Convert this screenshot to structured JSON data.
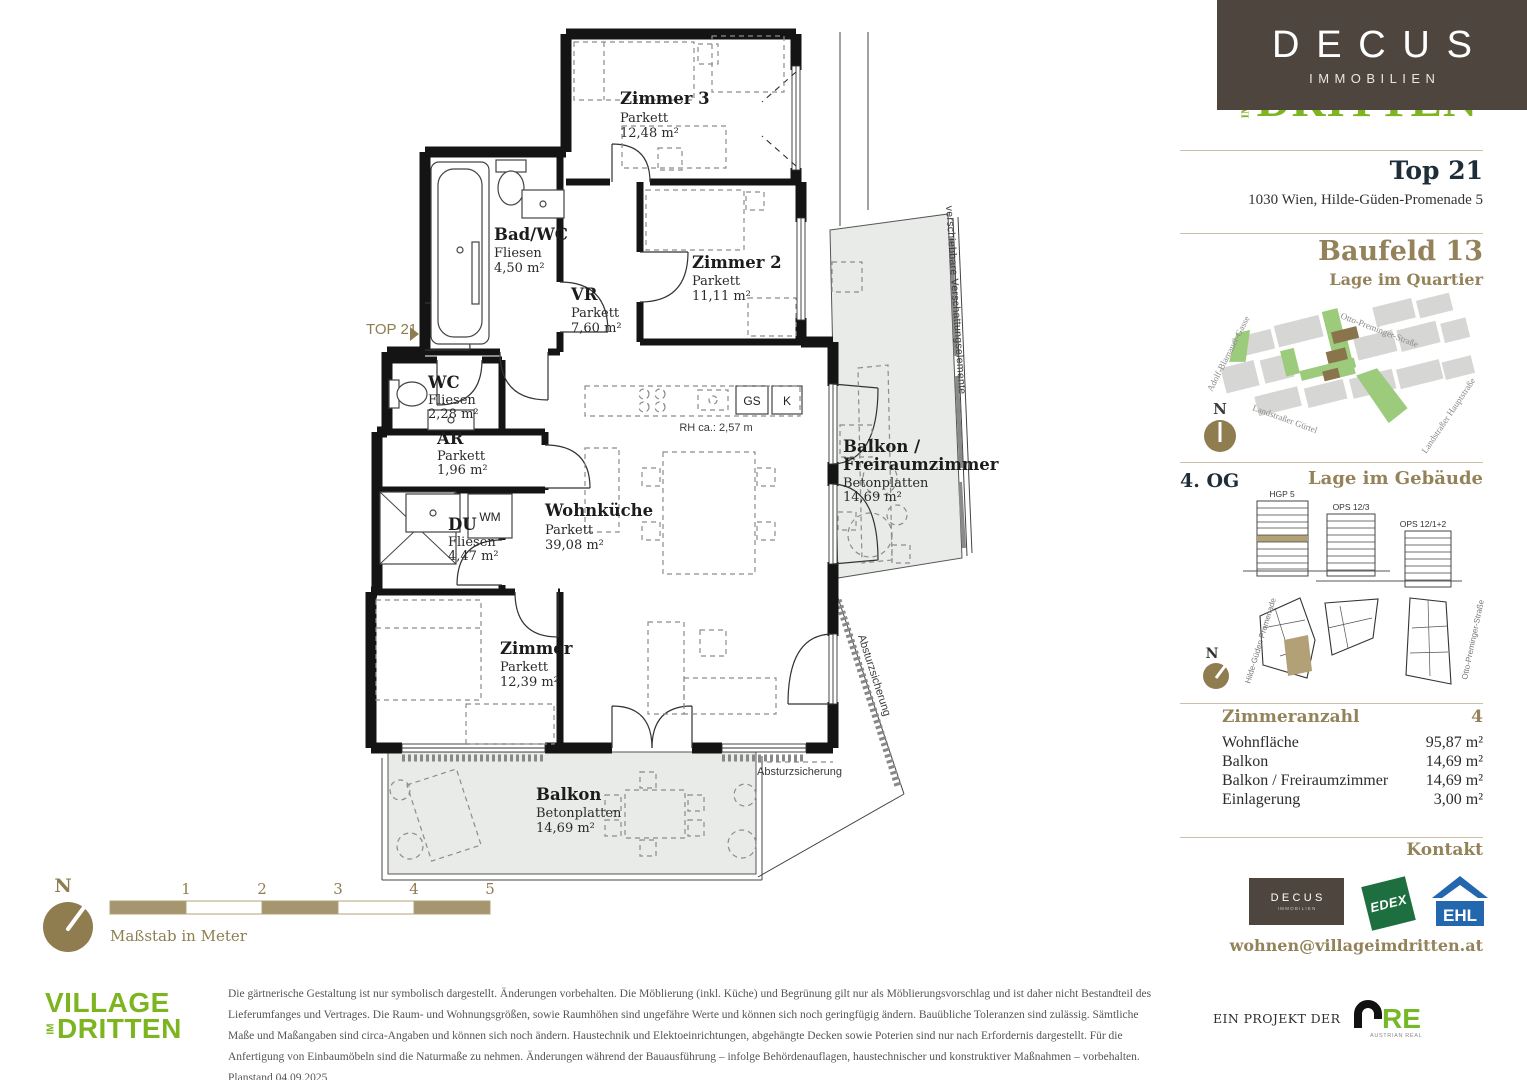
{
  "colors": {
    "brand_brown": "#94835A",
    "compass_brown": "#8F7D50",
    "village_green": "#7CB520",
    "decus_box": "#4D453E",
    "edex_green": "#1E6F40",
    "ehl_blue": "#2367AE",
    "are_green": "#76B82A",
    "map_green": "#9CCB7C",
    "map_gray": "#D6D6D4",
    "map_brown_building": "#8A744C",
    "highlight_tan": "#B2A177",
    "balcony_fill": "#E9EBE8",
    "heading_dark": "#1F2D38",
    "disclaimer_gray": "#555555"
  },
  "header": {
    "decus_logo": {
      "name": "DECUS",
      "sub": "IMMOBILIEN"
    },
    "partial_logo": {
      "im": "IM",
      "text": "DRITTEN"
    },
    "unit_title": "Top 21",
    "address": "1030 Wien, Hilde-Güden-Promenade 5",
    "baufeld": "Baufeld 13",
    "quartier_heading": "Lage im Quartier"
  },
  "map": {
    "compass": "N",
    "streets": {
      "s1": "Adolf-Blamauer-Gasse",
      "s2": "Otto-Preminger-Straße",
      "s3": "Landstraßer Gürtel",
      "s4": "Landstraßer Hauptstraße"
    }
  },
  "building": {
    "floor_label": "4. OG",
    "heading": "Lage im Gebäude",
    "compass": "N",
    "elevations": {
      "e1": "HGP 5",
      "e2": "OPS 12/3",
      "e3": "OPS 12/1+2"
    },
    "streets": {
      "left": "Hilde-Güden-Promenade",
      "right": "Otto-Preminger-Straße"
    }
  },
  "details": {
    "rows": [
      {
        "label": "Zimmeranzahl",
        "value": "4"
      },
      {
        "label": "Wohnfläche",
        "value": "95,87 m²"
      },
      {
        "label": "Balkon",
        "value": "14,69 m²"
      },
      {
        "label": "Balkon / Freiraumzimmer",
        "value": "14,69 m²"
      },
      {
        "label": "Einlagerung",
        "value": "3,00 m²"
      }
    ]
  },
  "kontakt": {
    "heading": "Kontakt",
    "email": "wohnen@villageimdritten.at",
    "logos": {
      "decus": {
        "name": "DECUS",
        "sub": "IMMOBILIEN"
      },
      "edex": "EDEX",
      "ehl": "EHL"
    }
  },
  "footer": {
    "village_logo": {
      "line1": "VILLAGE",
      "im": "IM",
      "line2": "DRITTEN"
    },
    "disclaimer": "Die gärtnerische Gestaltung ist nur symbolisch dargestellt. Änderungen vorbehalten. Die Möblierung (inkl. Küche) und Begrünung gilt nur als Möblierungsvorschlag und ist daher nicht Bestandteil des Lieferumfanges und Vertrages. Die Raum- und Wohnungsgrößen, sowie Raumhöhen sind ungefähre Werte und können sich noch geringfügig ändern. Bauübliche Toleranzen sind zulässig. Sämtliche Maße und Maßangaben sind circa-Angaben und können sich noch ändern. Haustechnik und Elektoeinrichtungen, abgehängte Decken sowie Poterien sind nur nach Erfordernis dargestellt. Für die Anfertigung von Einbaumöbeln sind die Naturmaße zu nehmen. Änderungen während der Bauausführung – infolge Behördenauflagen, haustechnischer und konstruktiver Maßnahmen – vorbehalten. Planstand 04.09.2025",
    "project_label": "EIN PROJEKT DER",
    "are": {
      "main": "RE",
      "sub": "AUSTRIAN REAL ESTATE"
    }
  },
  "plan": {
    "unit_marker": "TOP 21",
    "rooms": {
      "zimmer3": {
        "name": "Zimmer 3",
        "floor": "Parkett",
        "area": "12,48 m²"
      },
      "badwc": {
        "name": "Bad/WC",
        "floor": "Fliesen",
        "area": "4,50 m²"
      },
      "zimmer2": {
        "name": "Zimmer 2",
        "floor": "Parkett",
        "area": "11,11 m²"
      },
      "vr": {
        "name": "VR",
        "floor": "Parkett",
        "area": "7,60 m²"
      },
      "wc": {
        "name": "WC",
        "floor": "Fliesen",
        "area": "2,28 m²"
      },
      "ar": {
        "name": "AR",
        "floor": "Parkett",
        "area": "1,96 m²"
      },
      "du": {
        "name": "DU",
        "floor": "Fliesen",
        "area": "4,47 m²"
      },
      "wohnkueche": {
        "name": "Wohnküche",
        "floor": "Parkett",
        "area": "39,08 m²"
      },
      "zimmer": {
        "name": "Zimmer",
        "floor": "Parkett",
        "area": "12,39 m²"
      },
      "balkon": {
        "name": "Balkon",
        "floor": "Betonplatten",
        "area": "14,69 m²"
      },
      "freiraum": {
        "name1": "Balkon /",
        "name2": "Freiraumzimmer",
        "floor": "Betonplatten",
        "area": "14,69 m²"
      }
    },
    "annotations": {
      "wm": "WM",
      "gs": "GS",
      "k": "K",
      "rh": "RH ca.: 2,57 m",
      "shading": "verschiebbare Verschattungselemente",
      "fall": "Absturzsicherung"
    },
    "scalebar": {
      "n1": "1",
      "n2": "2",
      "n3": "3",
      "n4": "4",
      "n5": "5",
      "label": "Maßstab in Meter",
      "compass": "N"
    }
  }
}
